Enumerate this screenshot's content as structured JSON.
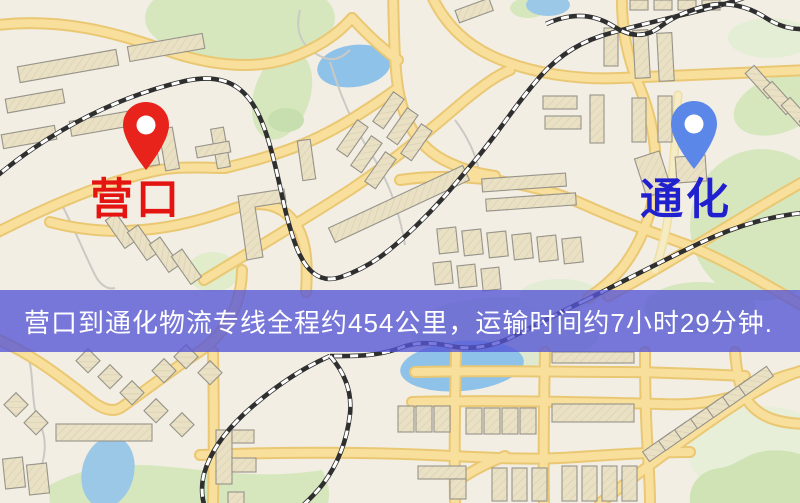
{
  "map": {
    "origin": {
      "label": "营口",
      "label_color": "#e41411",
      "pin_color": "#e8231b"
    },
    "destination": {
      "label": "通化",
      "label_color": "#2020cf",
      "pin_color": "#5b87e8"
    }
  },
  "banner": {
    "text": "营口到通化物流专线全程约454公里，运输时间约7小时29分钟.",
    "background_color": "#5454d6",
    "text_color": "#ffffff"
  }
}
